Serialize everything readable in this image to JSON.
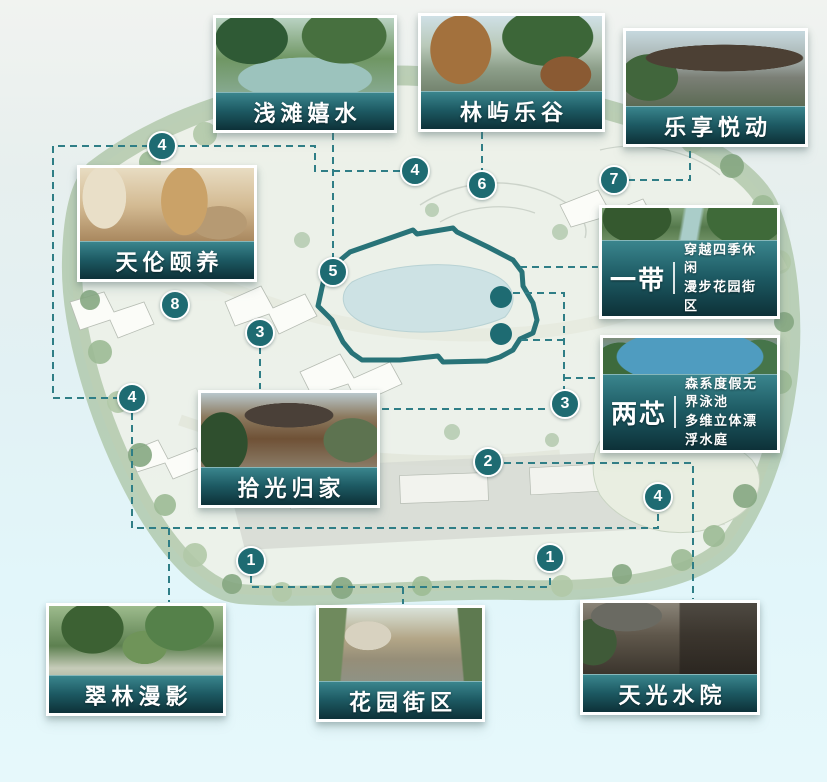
{
  "colors": {
    "accent_teal": "#1e6b72",
    "banner_gradient_top": "#3a858d",
    "banner_gradient_bottom": "#0d3138",
    "dashed_connector": "#2f7e86",
    "marker_fill": "#1e6b72",
    "belt_loop": "#1e6b72"
  },
  "cards": {
    "qiantan": {
      "title": "浅滩嬉水"
    },
    "linyu": {
      "title": "林屿乐谷"
    },
    "lexiang": {
      "title": "乐享悦动"
    },
    "tianlun": {
      "title": "天伦颐养"
    },
    "yidai": {
      "title": "一带",
      "desc1": "穿越四季休闲",
      "desc2": "漫步花园街区"
    },
    "liangxin": {
      "title": "两芯",
      "desc1": "森系度假无界泳池",
      "desc2": "多维立体漂浮水庭"
    },
    "shiguang": {
      "title": "拾光归家"
    },
    "cuilin": {
      "title": "翠林漫影"
    },
    "huayuan": {
      "title": "花园街区"
    },
    "tianguang": {
      "title": "天光水院"
    }
  },
  "markers": [
    "4",
    "4",
    "6",
    "7",
    "5",
    "8",
    "3",
    "3",
    "4",
    "2",
    "4",
    "1",
    "1"
  ]
}
